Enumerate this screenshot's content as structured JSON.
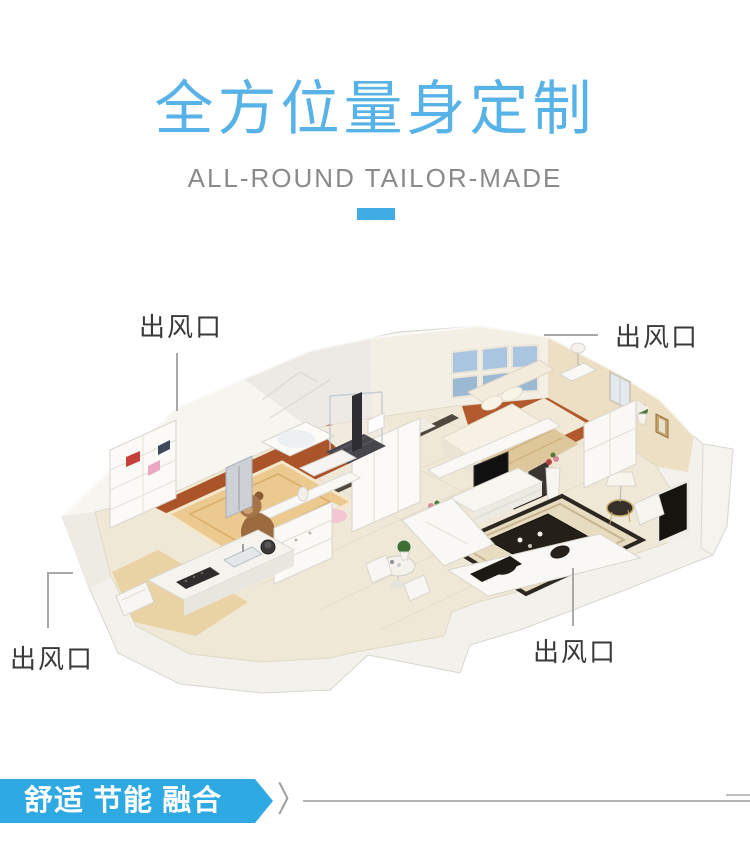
{
  "header": {
    "title": "全方位量身定制",
    "subtitle": "ALL-ROUND TAILOR-MADE"
  },
  "callouts": {
    "top_left": {
      "label": "出风口"
    },
    "top_right": {
      "label": "出风口"
    },
    "bottom_left": {
      "label": "出风口"
    },
    "bottom_center": {
      "label": "出风口"
    }
  },
  "footer": {
    "ribbon_label": "舒适 节能 融合",
    "chevron": "〉"
  },
  "illustration": {
    "description": "isometric 3D render of an apartment floor plan with bedroom, kids room, bathroom, kitchen, hallway and living room"
  },
  "colors": {
    "accent_blue": "#57b2e7",
    "divider_blue": "#3fade3",
    "ribbon_blue": "#2fa9e1",
    "label_text": "#3a3a3a",
    "subtitle_gray": "#8a8a8a",
    "line_gray": "#b5b5b5"
  }
}
